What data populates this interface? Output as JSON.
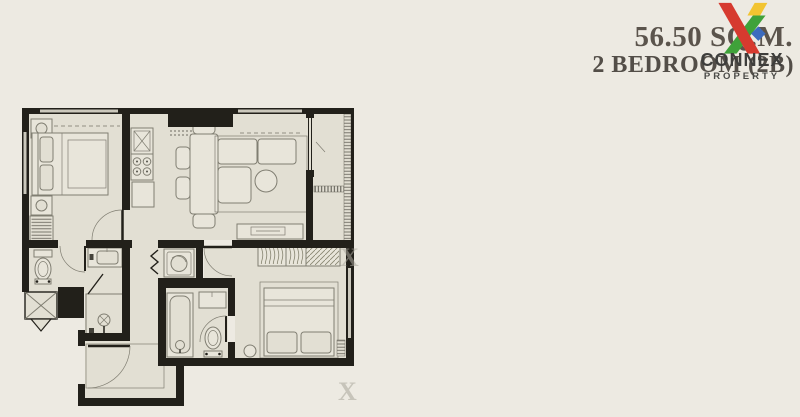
{
  "header": {
    "area_label": "56.50 SQ.M.",
    "unit_label": "2 BEDROOM (2B)"
  },
  "logo": {
    "brand": "CONNEX",
    "tagline": "PROPERTY",
    "icon": "connex-x-logo"
  },
  "palette": {
    "bg": "#EDEAE2",
    "floor": "#E2DFD3",
    "wall": "#22201A",
    "line": "#807E72",
    "furn": "#E8E5DA",
    "lightline": "#CBC8BC",
    "title": "#5B544C",
    "brand": "#3E3E3C",
    "tagline": "#4A4A47",
    "logo-red": "#D63A2F",
    "logo-green": "#3FA23A",
    "logo-yellow": "#F2C431",
    "logo-blue": "#3C6BBE"
  },
  "floor_plan": {
    "type": "2-bedroom condominium unit floor plan",
    "rooms": [
      {
        "name": "bedroom-1",
        "fixtures": [
          "double-bed",
          "nightstand",
          "nightstand",
          "wardrobe",
          "window"
        ]
      },
      {
        "name": "kitchen",
        "fixtures": [
          "sink-counter",
          "4-burner-stove",
          "counter"
        ]
      },
      {
        "name": "dining-area",
        "fixtures": [
          "dining-table",
          "chair",
          "chair",
          "chair",
          "chair"
        ]
      },
      {
        "name": "living-area",
        "fixtures": [
          "l-shaped-sofa",
          "round-coffee-table",
          "tv-console"
        ]
      },
      {
        "name": "balcony",
        "fixtures": [
          "sliding-door",
          "louver-strip"
        ]
      },
      {
        "name": "bathroom-1",
        "fixtures": [
          "toilet",
          "sink-vanity",
          "shower-stall"
        ]
      },
      {
        "name": "washer-closet",
        "fixtures": [
          "washing-machine",
          "folding-door"
        ]
      },
      {
        "name": "bathroom-2",
        "fixtures": [
          "bathtub",
          "sink",
          "toilet"
        ]
      },
      {
        "name": "bedroom-2",
        "fixtures": [
          "double-bed",
          "wardrobe",
          "stool",
          "window"
        ]
      },
      {
        "name": "entrance-hall",
        "fixtures": [
          "entrance-door"
        ]
      },
      {
        "name": "ac-ledge",
        "fixtures": [
          "shaft-x-mark"
        ]
      }
    ]
  }
}
